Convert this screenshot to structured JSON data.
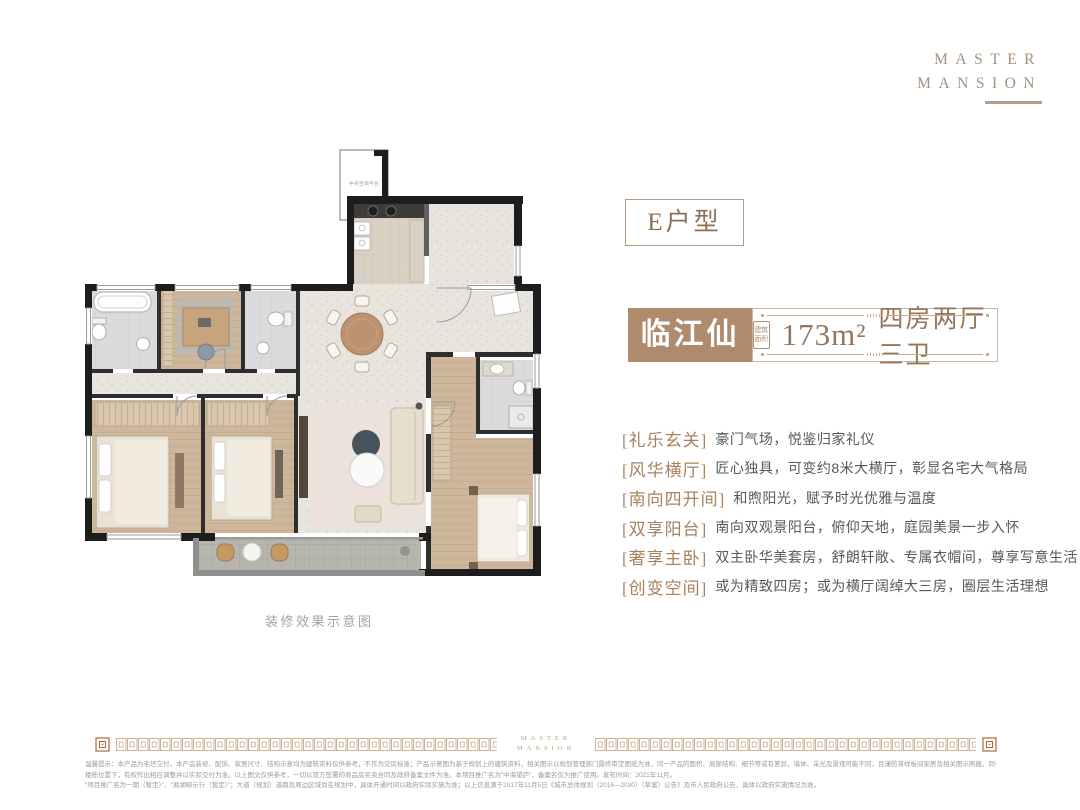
{
  "brand": {
    "line1": "MASTER",
    "line2": "MANSION"
  },
  "unit": {
    "type_label": "E户型",
    "name": "临江仙",
    "area_stamp_line1": "建筑",
    "area_stamp_line2": "面积",
    "area_value": "173m²",
    "layout": "四房两厅三卫"
  },
  "features": [
    {
      "tag": "[礼乐玄关]",
      "desc": "豪门气场，悦鉴归家礼仪"
    },
    {
      "tag": "[风华横厅]",
      "desc": "匠心独具，可变约8米大横厅，彰显名宅大气格局"
    },
    {
      "tag": "[南向四开间]",
      "desc": "和煦阳光，赋予时光优雅与温度"
    },
    {
      "tag": "[双享阳台]",
      "desc": "南向双观景阳台，俯仰天地，庭园美景一步入怀"
    },
    {
      "tag": "[奢享主卧]",
      "desc": "双主卧华美套房，舒朗轩敞、专属衣帽间，尊享写意生活"
    },
    {
      "tag": "[创变空间]",
      "desc": "或为精致四房；或为横厅阔绰大三房，圈层生活理想"
    }
  ],
  "floorplan": {
    "caption": "装修效果示意图",
    "platform_label": "中央空调平台"
  },
  "footer": {
    "logo_line1": "MASTER",
    "logo_line2": "MANSION"
  },
  "disclaimer": {
    "line1": "温馨提示：本产品为毛坯交付，本产品装修、配饰、家居尺寸、结构示意均为建筑资料仅供参考，不作为交房标准；产品示意图为基于规划上的建筑资料，相关图示以规划管理部门最终审定图纸为准，同一产品的面积、局部结构、细节等或有差异，墙体、采光及景观可能不同，且谨防将样板间家居及相关图示照搬，同一产品在不同",
    "line2": "楼栋位置下，有权作出相应调整并以实际交付为准。以上图文仅供参考，一切以双方签署的商品房买卖合同及政府备案文件为准。本项目推广名为“中海望庐”，备案名仅为推广使用。发布时间：2021年11月。",
    "line3": "“项目推广名为一期（暂定）”、“湘湖映示行（暂定）”；大道（规划）道路及周边区域尚在规划中，具体开通时间以政府实际实施为准；以上信息源于2017年11月5日《城市总体规划（2016—2030）（草案）公告》及市人民政府公告，具体以政府实施情况为准。"
  },
  "colors": {
    "accent_brown": "#ae8b6c",
    "tag_brown": "#a9825e",
    "body_text": "#5a5757",
    "border_tan": "#cbb69e",
    "logo_tan": "#a7917d",
    "wall_black": "#1d1d1d"
  }
}
